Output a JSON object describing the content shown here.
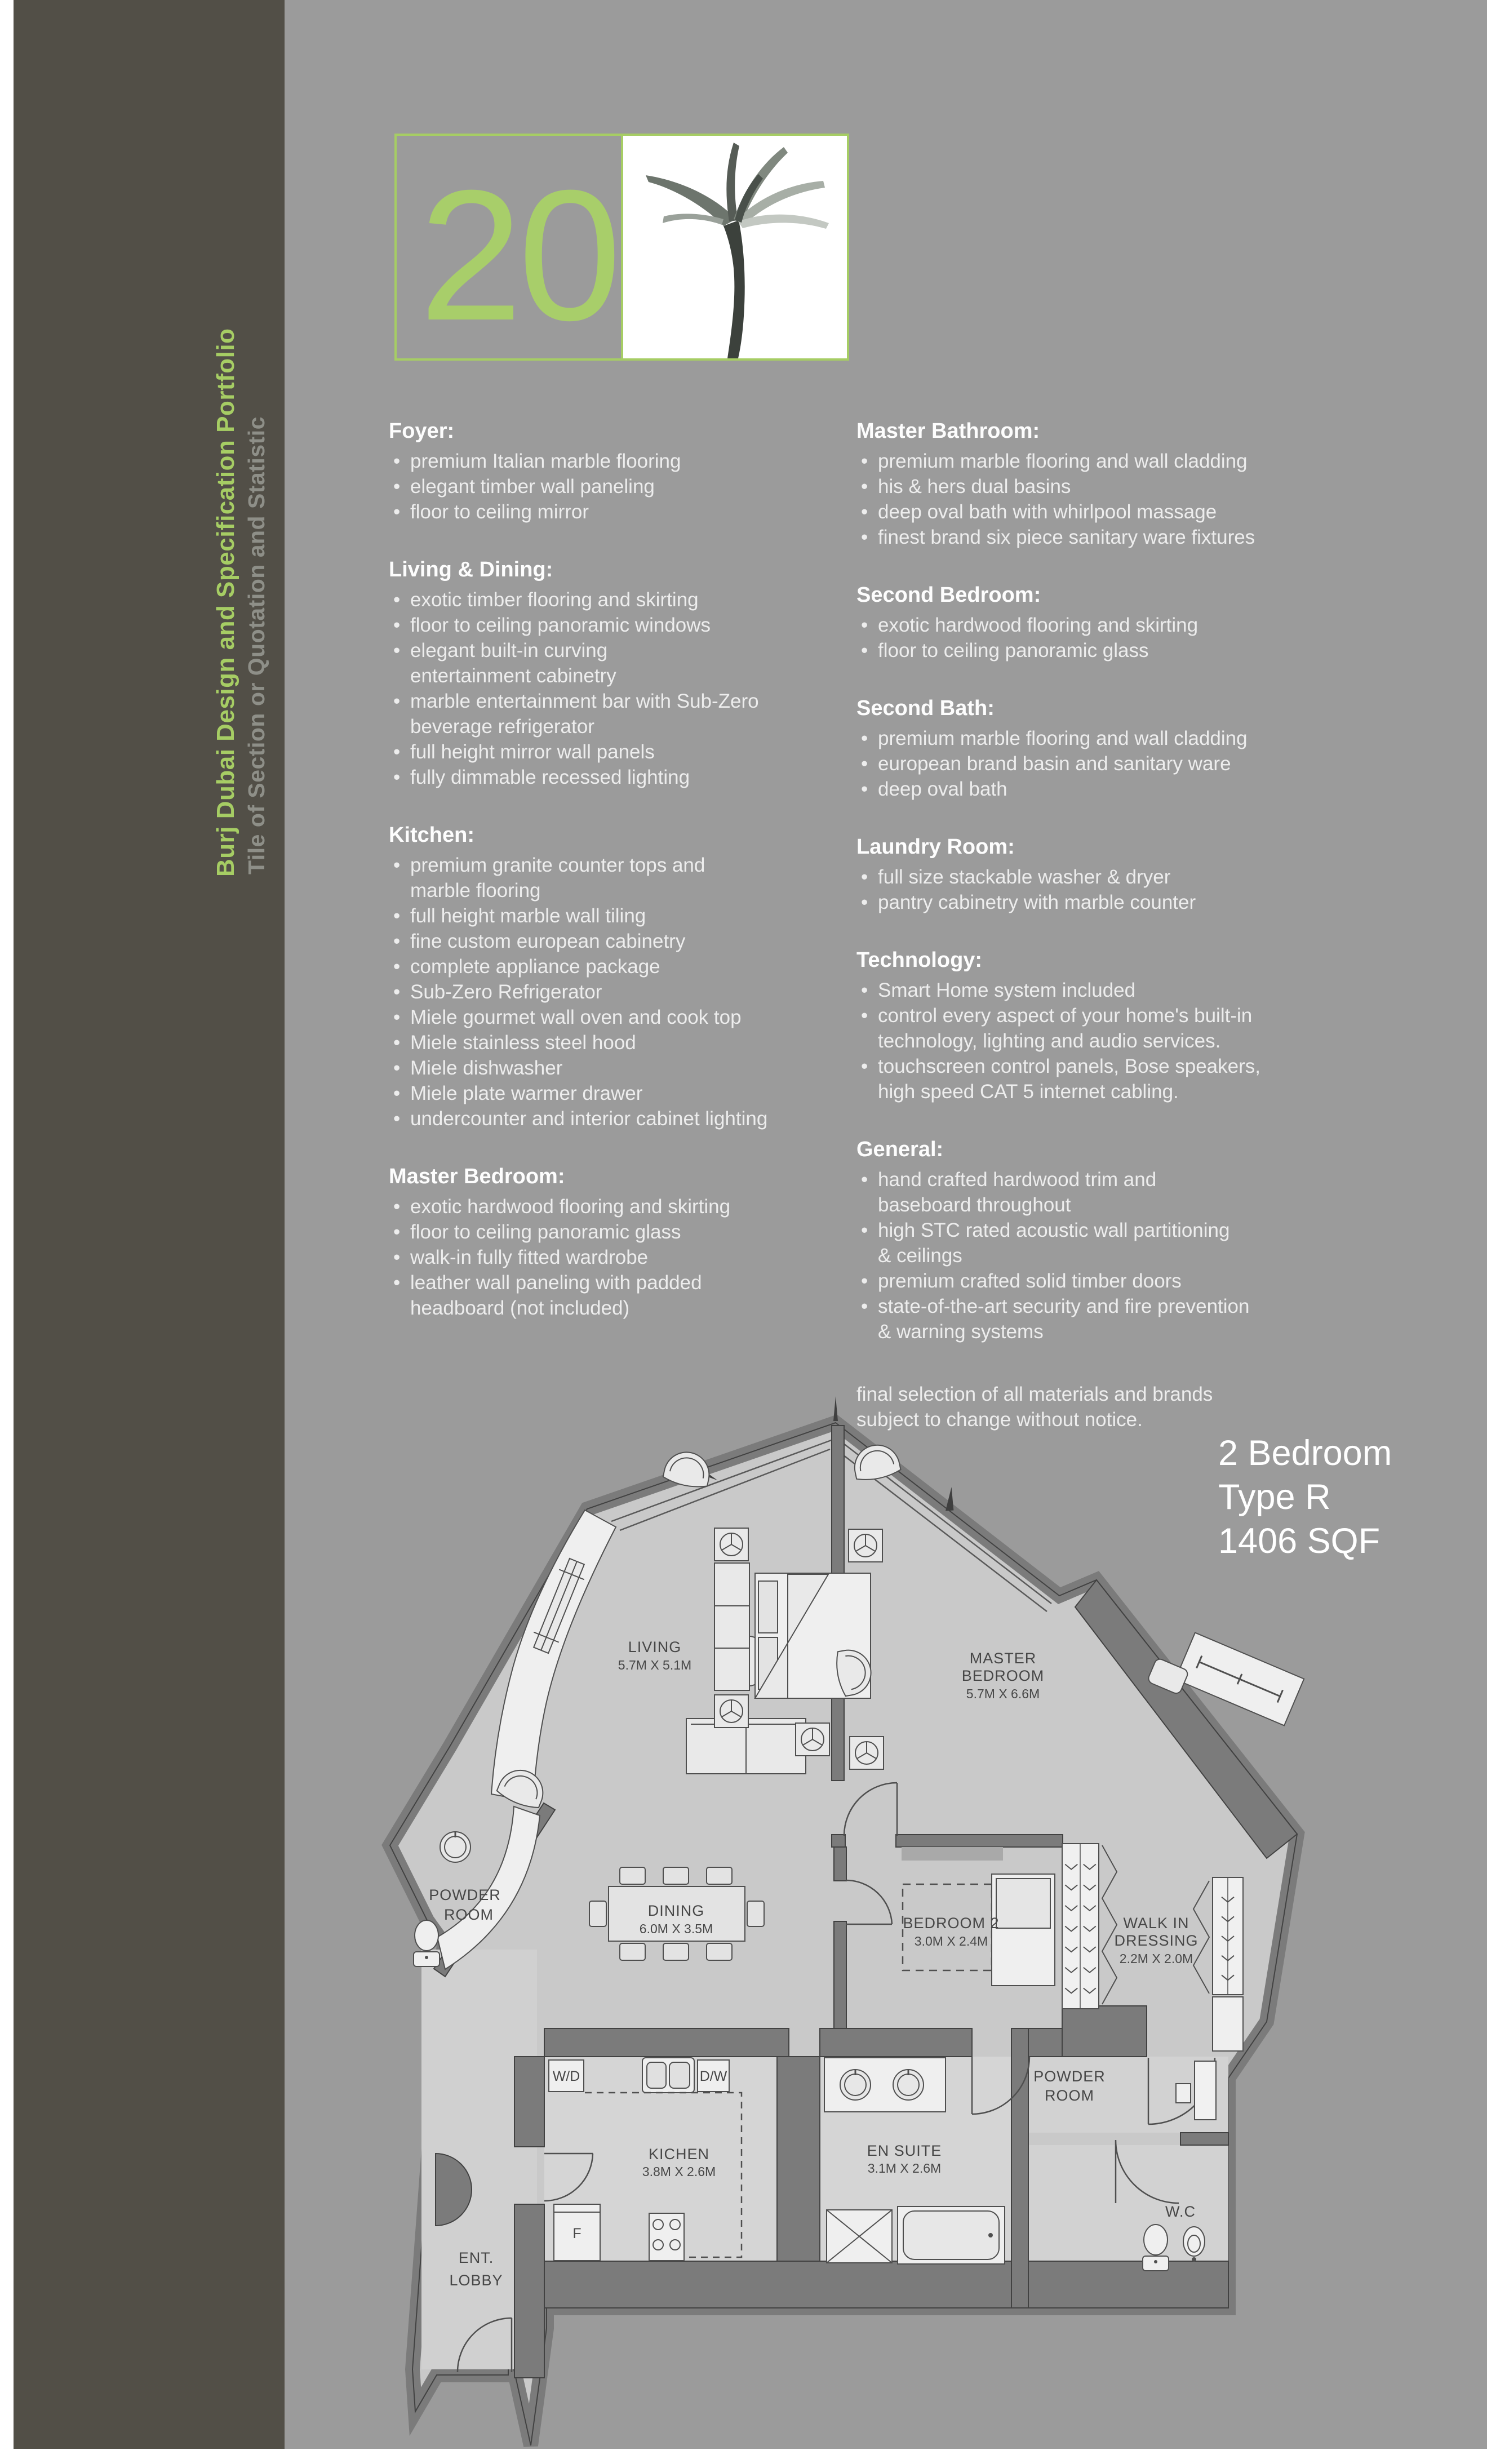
{
  "page": {
    "background": "#9b9b9b",
    "sidebar_color": "#524f47",
    "accent_green": "#a6cd64",
    "page_number": "20"
  },
  "sidebar": {
    "title": "Burj Dubai Design and Specification Portfolio",
    "subtitle": "Tile of Section or Quotation and Statistic"
  },
  "unit": {
    "label": "2 Bedroom\nType R\n1406 SQF"
  },
  "specs": {
    "left_sections": [
      {
        "heading": "Foyer:",
        "items": [
          "premium Italian marble flooring",
          "elegant timber wall paneling",
          "floor to ceiling mirror"
        ]
      },
      {
        "heading": "Living & Dining:",
        "items": [
          "exotic timber flooring and skirting",
          "floor to ceiling panoramic windows",
          "elegant built-in curving\nentertainment cabinetry",
          "marble entertainment bar with Sub-Zero\nbeverage refrigerator",
          "full height mirror wall panels",
          "fully dimmable recessed lighting"
        ]
      },
      {
        "heading": "Kitchen:",
        "items": [
          "premium granite counter tops and\nmarble flooring",
          "full height marble wall tiling",
          "fine custom european cabinetry",
          "complete appliance package",
          "Sub-Zero Refrigerator",
          "Miele gourmet wall oven and cook top",
          "Miele stainless steel hood",
          "Miele dishwasher",
          "Miele plate warmer drawer",
          "undercounter and interior cabinet lighting"
        ]
      },
      {
        "heading": "Master Bedroom:",
        "items": [
          "exotic hardwood flooring and skirting",
          "floor to ceiling panoramic glass",
          "walk-in fully fitted wardrobe",
          "leather wall paneling with padded\nheadboard (not included)"
        ]
      }
    ],
    "right_sections": [
      {
        "heading": "Master Bathroom:",
        "items": [
          "premium marble flooring and wall cladding",
          "his & hers dual basins",
          "deep oval bath with whirlpool massage",
          "finest brand six piece sanitary ware fixtures"
        ]
      },
      {
        "heading": "Second Bedroom:",
        "items": [
          "exotic hardwood flooring and skirting",
          "floor to ceiling panoramic glass"
        ]
      },
      {
        "heading": "Second Bath:",
        "items": [
          "premium marble flooring and wall cladding",
          "european brand basin and sanitary ware",
          "deep oval bath"
        ]
      },
      {
        "heading": "Laundry Room:",
        "items": [
          "full size stackable washer & dryer",
          "pantry cabinetry with marble counter"
        ]
      },
      {
        "heading": "Technology:",
        "items": [
          "Smart Home system included",
          "control every aspect of your home's built-in\ntechnology, lighting and audio services.",
          "touchscreen control panels, Bose speakers,\nhigh speed CAT 5 internet cabling."
        ]
      },
      {
        "heading": "General:",
        "items": [
          "hand crafted hardwood trim and\nbaseboard throughout",
          "high STC rated acoustic wall partitioning\n& ceilings",
          "premium crafted solid timber doors",
          "state-of-the-art security and fire prevention\n& warning systems"
        ]
      }
    ],
    "disclaimer": "final selection of all materials and brands\nsubject to change without notice."
  },
  "floorplan": {
    "living": {
      "name": "LIVING",
      "dims": "5.7M X 5.1M"
    },
    "master": {
      "name_line1": "MASTER",
      "name_line2": "BEDROOM",
      "dims": "5.7M X 6.6M"
    },
    "dining": {
      "name": "DINING",
      "dims": "6.0M X 3.5M"
    },
    "bedroom2": {
      "name": "BEDROOM 2",
      "dims": "3.0M X 2.4M"
    },
    "walkin": {
      "name_line1": "WALK IN",
      "name_line2": "DRESSING",
      "dims": "2.2M X 2.0M"
    },
    "kitchen": {
      "name": "KICHEN",
      "dims": "3.8M X 2.6M"
    },
    "ensuite": {
      "name": "EN SUITE",
      "dims": "3.1M X 2.6M"
    },
    "powder_left": {
      "name_line1": "POWDER",
      "name_line2": "ROOM"
    },
    "powder_right": {
      "name_line1": "POWDER",
      "name_line2": "ROOM"
    },
    "wc": {
      "name": "W.C"
    },
    "lobby": {
      "name_line1": "ENT.",
      "name_line2": "LOBBY"
    },
    "washer_dryer": "W/D",
    "dishwasher": "D/W",
    "fridge": "F"
  }
}
